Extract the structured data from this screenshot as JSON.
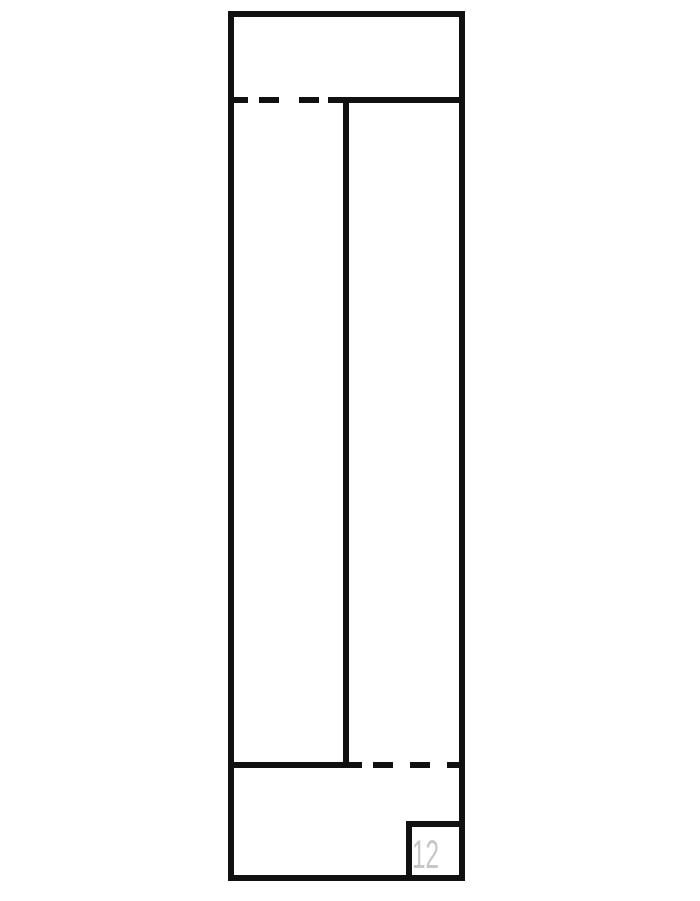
{
  "page": {
    "background_color": "#ffffff"
  },
  "drawing": {
    "type": "technical-line-drawing",
    "line_color": "#111111",
    "part_label": {
      "text": "12",
      "color": "#c6c6c6"
    }
  }
}
